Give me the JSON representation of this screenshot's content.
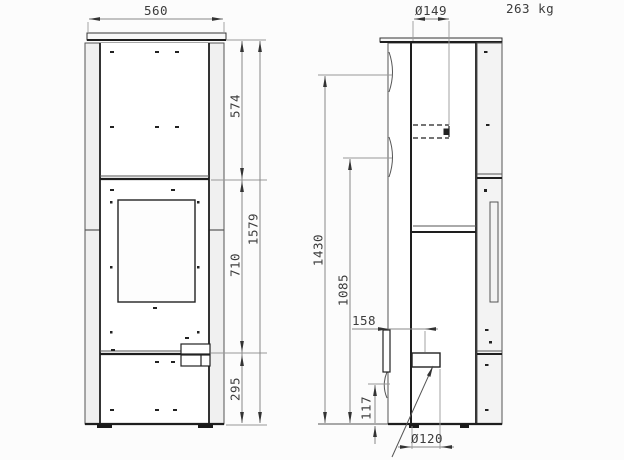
{
  "page": {
    "weight_label": "263 kg"
  },
  "front_view": {
    "dims": {
      "width": "560",
      "upper_section": "574",
      "door_section": "710",
      "base_section": "295",
      "total_height": "1579"
    }
  },
  "side_view": {
    "dims": {
      "flue_diameter": "Ø149",
      "flue_height": "1430",
      "outlet_height": "1085",
      "air_offset": "158",
      "air_height": "117",
      "air_diameter": "Ø120"
    }
  }
}
